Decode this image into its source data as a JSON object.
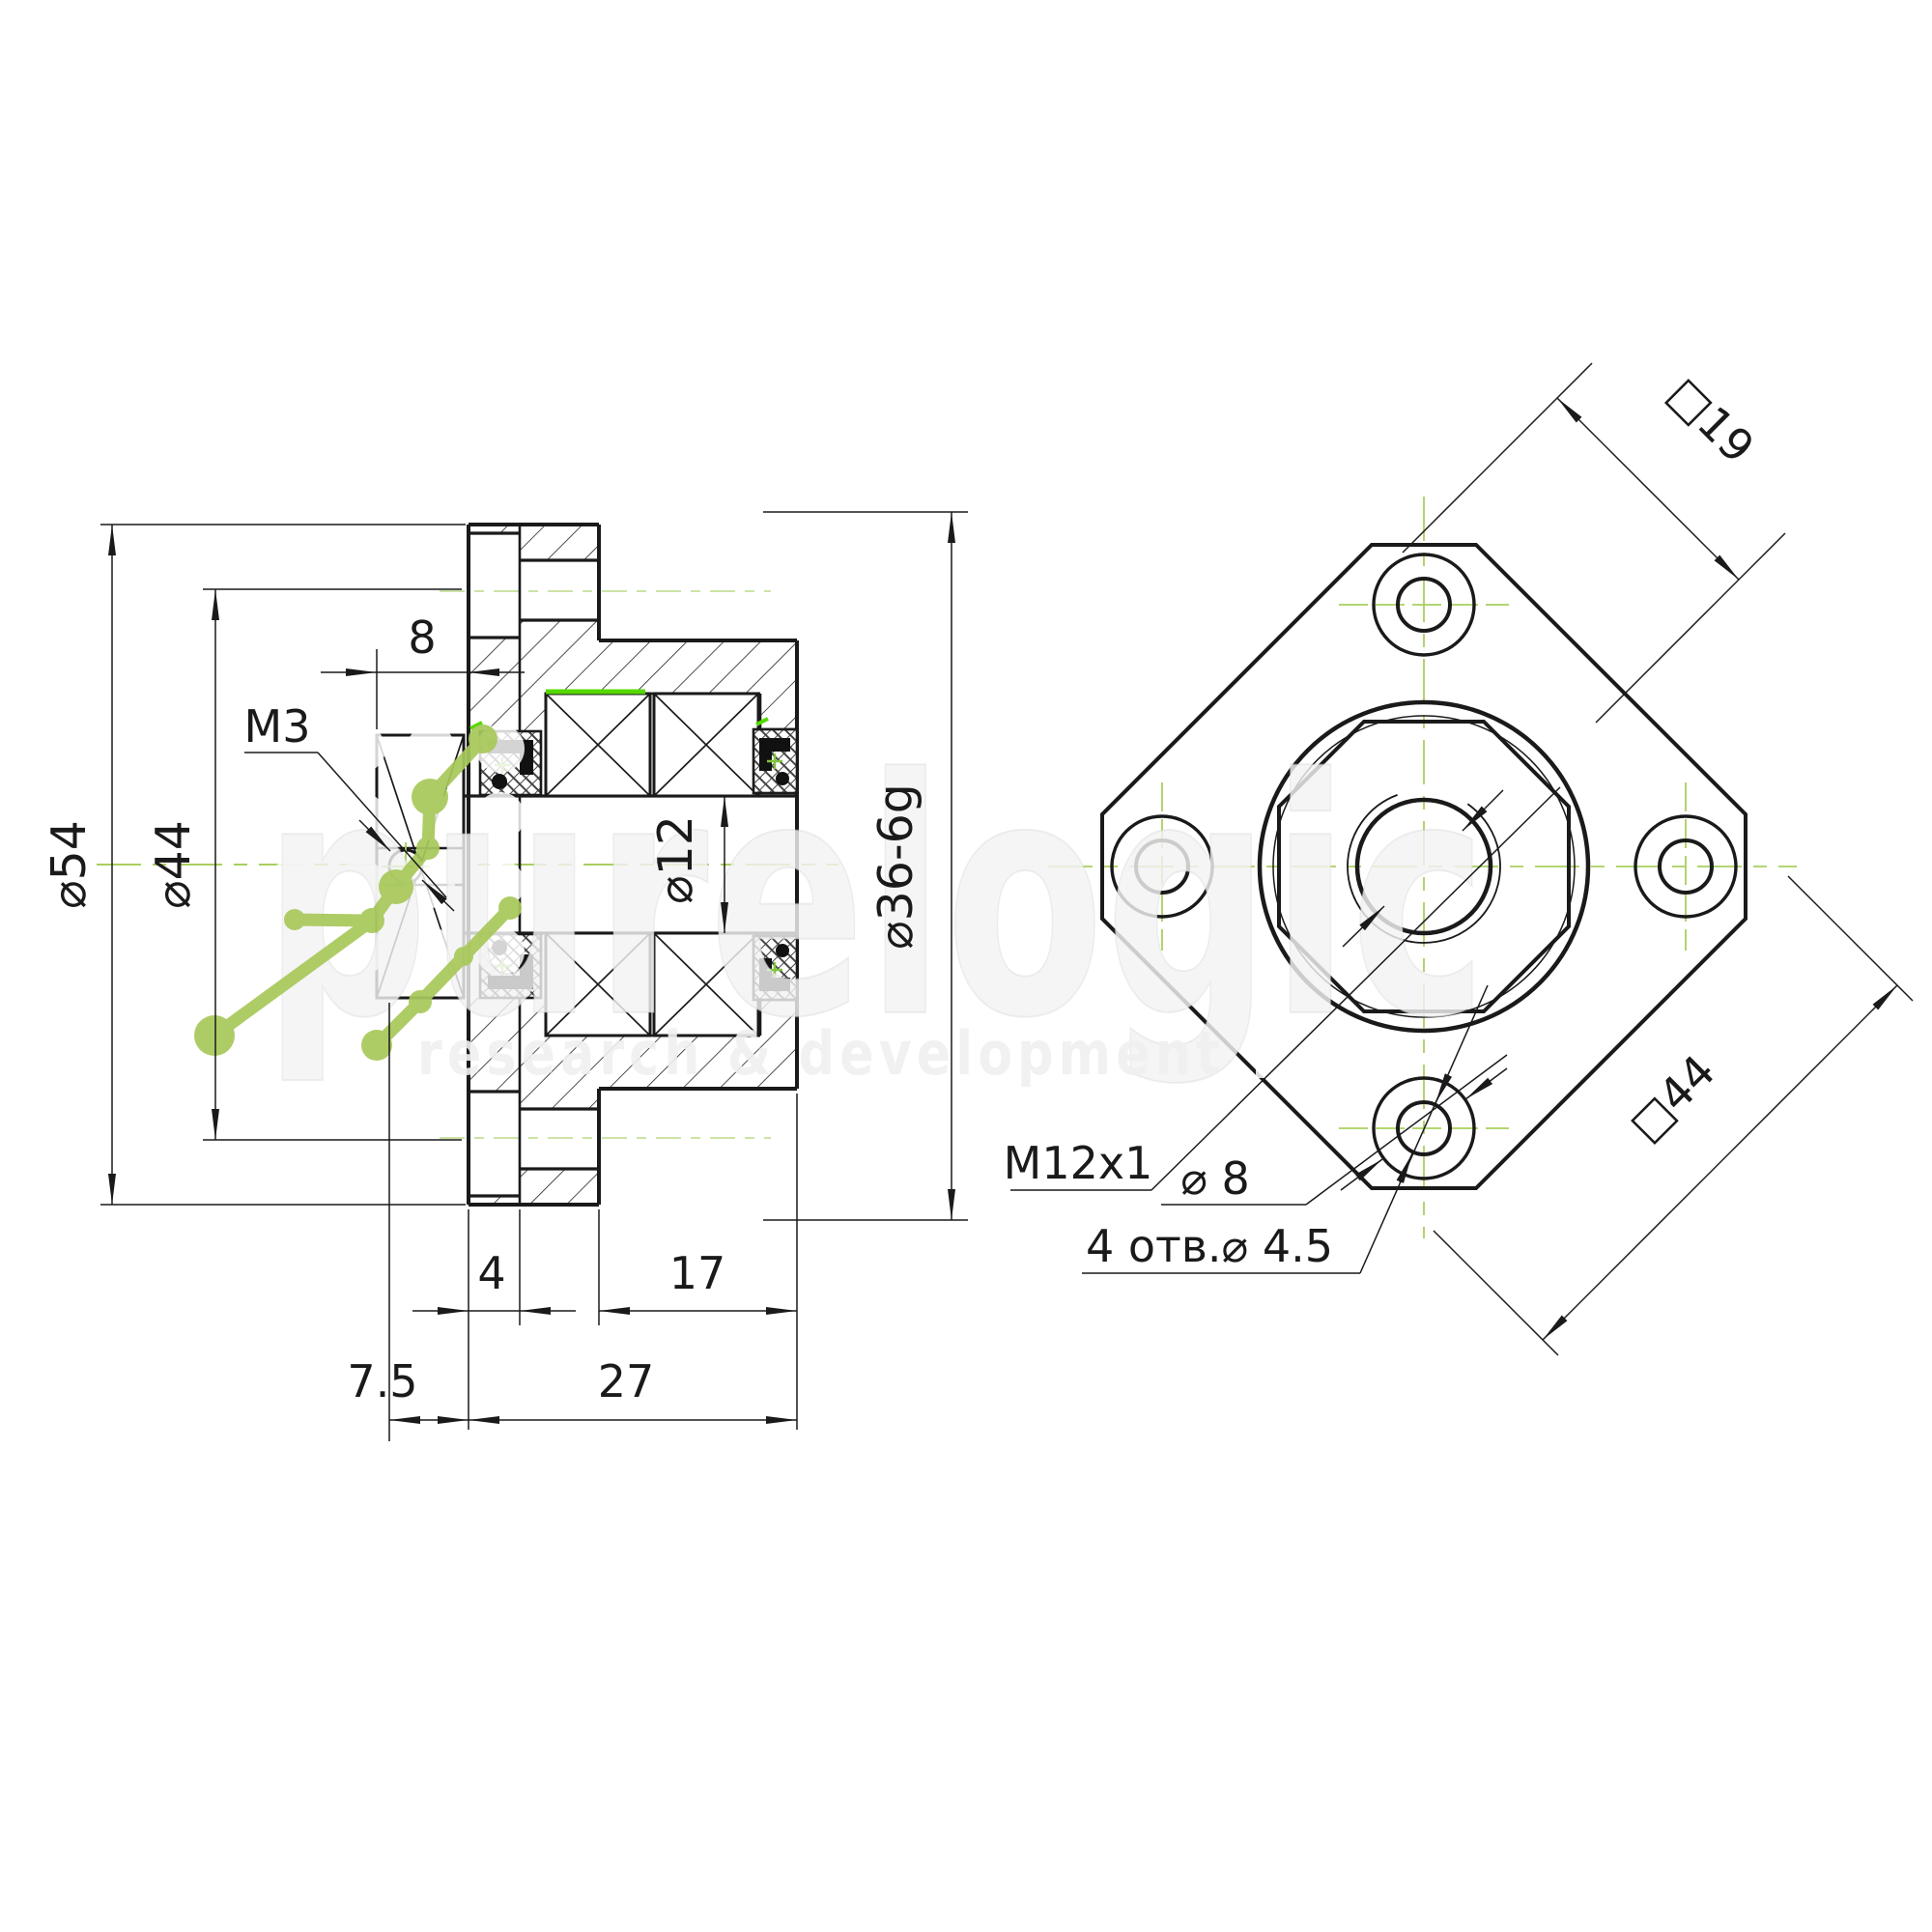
{
  "drawing_title": "ballscrew-support-unit-two-view-drawing",
  "colors": {
    "line": "#1a1a1a",
    "centerline_green": "#a9cf5f",
    "pale_centerline_green": "#c6df9a",
    "highlight_green": "#55d800",
    "logo_green": "#a8c85a",
    "watermark_white": "#f3f3f3"
  },
  "left_view": {
    "name": "section-view",
    "dia54": "⌀54",
    "dia44": "⌀44",
    "m3": "M3",
    "width8": "8",
    "dia12": "⌀12",
    "dia36": "⌀36-6g",
    "t4": "4",
    "l17": "17",
    "l75": "7.5",
    "l27": "27"
  },
  "right_view": {
    "name": "front-view",
    "sq19": "□19",
    "sq44": "□44",
    "m12x1": "M12x1",
    "dia8": "⌀ 8",
    "holes45": "4 отв.⌀ 4.5"
  },
  "watermark": {
    "line1": "purelogic",
    "line2": "research & development"
  }
}
